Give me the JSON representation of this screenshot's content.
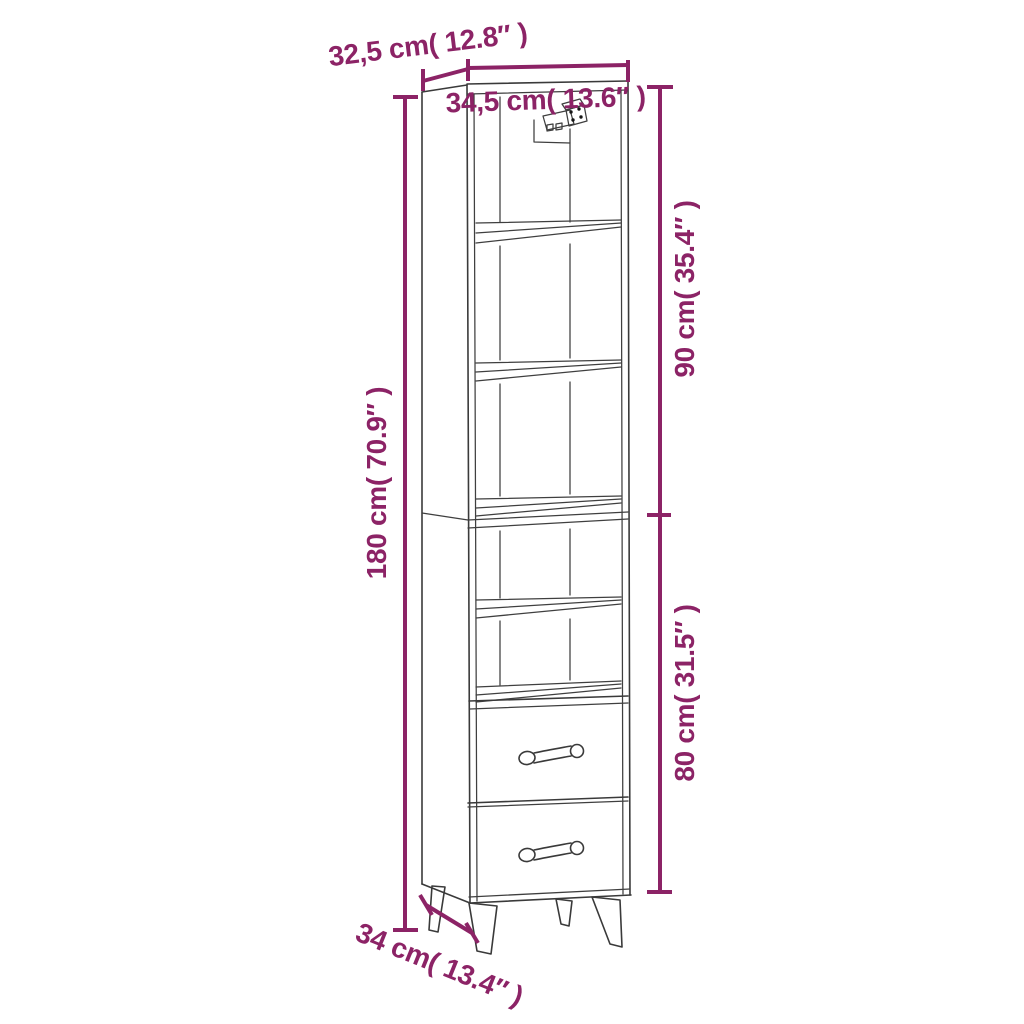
{
  "colors": {
    "dimension_annotation": "#8c2366",
    "drawing_outline": "#3a3a3a",
    "background": "#ffffff"
  },
  "drawing": {
    "subject": "Tall narrow highboard cabinet line drawing with five open shelf compartments, a wall-mount bracket shown in the top compartment, two drawers with bar handles and four splayed tapered legs"
  },
  "dimensions": {
    "top_depth": {
      "value_cm": "32,5",
      "value_in": "12.8",
      "label": "32,5 cm( 12.8″ )"
    },
    "top_width": {
      "value_cm": "34,5",
      "value_in": "13.6",
      "label": "34,5 cm( 13.6″ )"
    },
    "upper_section_height": {
      "value_cm": "90",
      "value_in": "35.4",
      "label": "90 cm( 35.4″ )"
    },
    "total_height": {
      "value_cm": "180",
      "value_in": "70.9",
      "label": "180 cm( 70.9″ )"
    },
    "lower_section_height": {
      "value_cm": "80",
      "value_in": "31.5",
      "label": "80 cm( 31.5″ )"
    },
    "base_depth": {
      "value_cm": "34",
      "value_in": "13.4",
      "label": "34 cm( 13.4″ )"
    }
  }
}
